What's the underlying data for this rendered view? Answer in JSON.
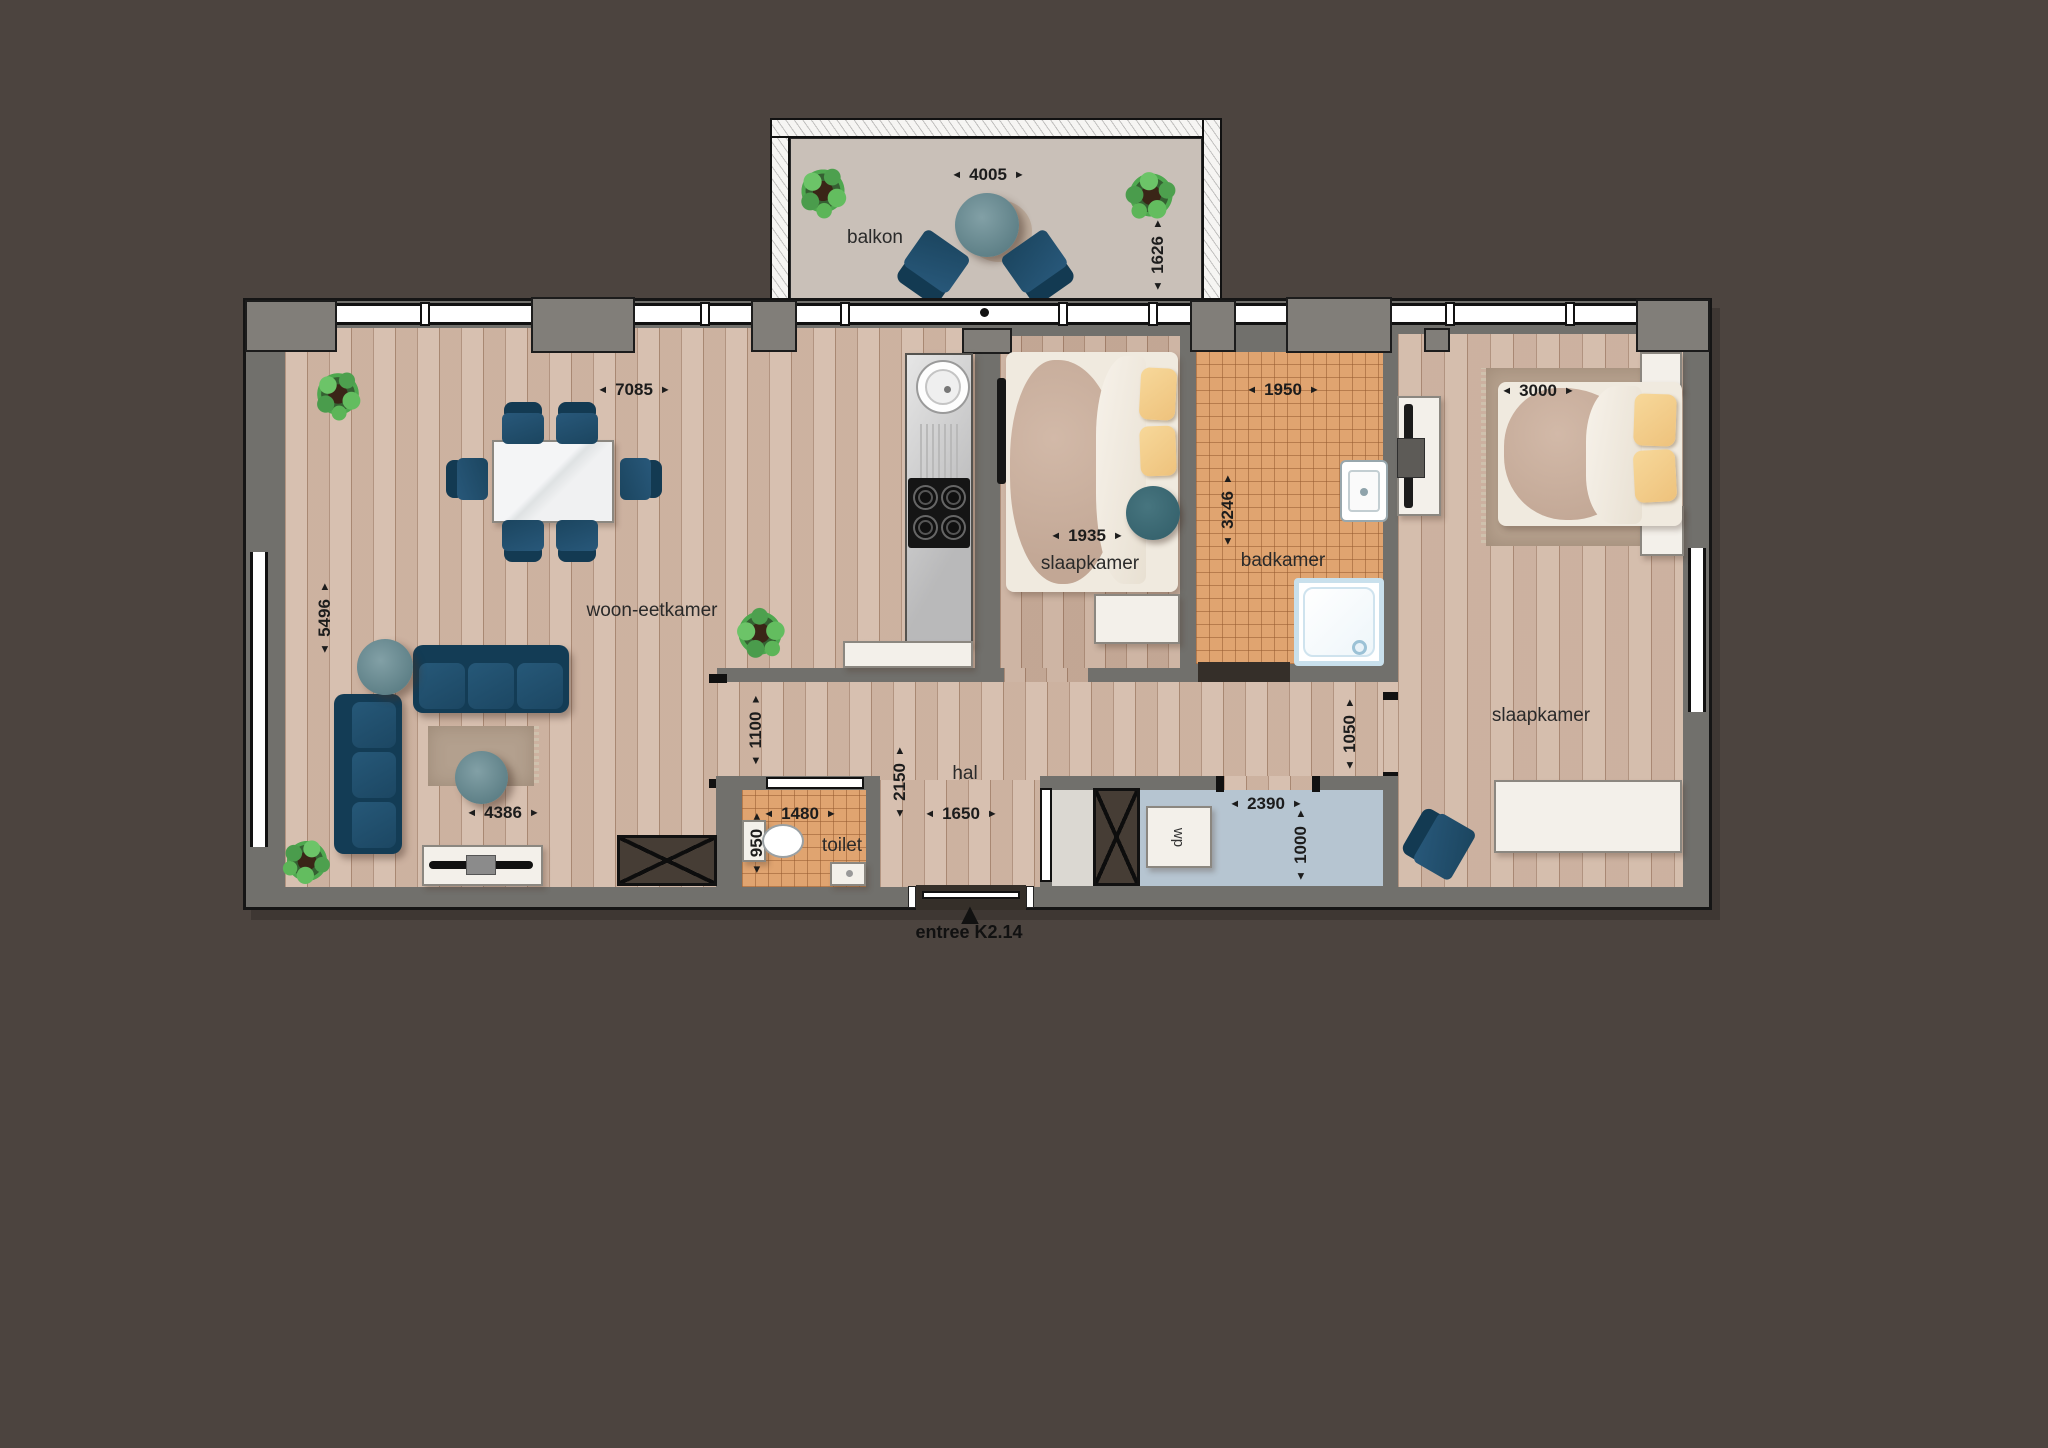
{
  "meta": {
    "type": "apartment-floor-plan",
    "unit_hint": "mm"
  },
  "glyphs": {
    "left": "◄",
    "right": "►",
    "entry": "▲"
  },
  "rooms": {
    "balkon": "balkon",
    "woon_eetkamer": "woon-eetkamer",
    "slaapkamer_1": "slaapkamer",
    "badkamer": "badkamer",
    "slaapkamer_2": "slaapkamer",
    "hal": "hal",
    "toilet": "toilet",
    "wp": "wp"
  },
  "entry_label": "entree K2.14",
  "dims": {
    "balkon_w": "4005",
    "balkon_d": "1626",
    "woon_w": "7085",
    "woon_d": "5496",
    "woon_w2": "4386",
    "slaap1_w": "1935",
    "bad_w": "1950",
    "bad_d": "3246",
    "slaap2_w": "3000",
    "hal_pass": "1100",
    "hal_d": "2150",
    "hal_w": "1650",
    "toilet_w": "1480",
    "toilet_d": "950",
    "berging_w": "2390",
    "berging_d": "1000",
    "hal_r": "1050"
  },
  "colors": {
    "bg": "#4c443f",
    "wall": "#71706c",
    "wood": "#d5bcab",
    "tile": "#e0a470",
    "closet": "#b6c5d1",
    "balcony": "#c9c0b8",
    "rug": "#b3a08e",
    "furniture_blue": "#1d4a63",
    "pillow_yellow": "#f4cf8b",
    "plant_green": "#53ad52"
  }
}
